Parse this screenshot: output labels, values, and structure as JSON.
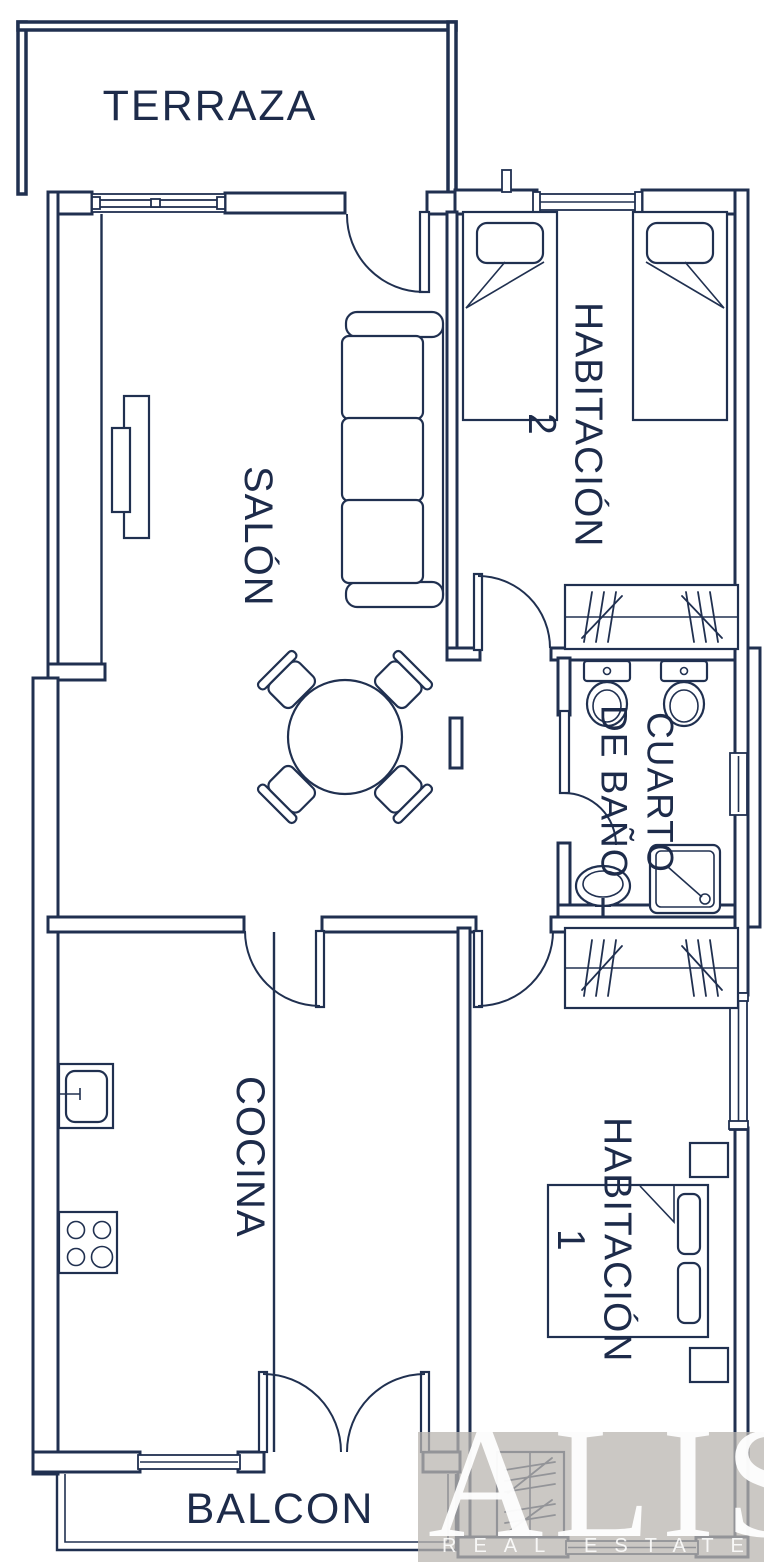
{
  "rooms": {
    "terraza": "TERRAZA",
    "salon": "SALÓN",
    "habitacion2": {
      "name": "HABITACIÓN",
      "number": "2"
    },
    "cuarto_de_bano": {
      "line1": "CUARTO",
      "line2": "DE BAÑO"
    },
    "cocina": "COCINA",
    "habitacion1": {
      "name": "HABITACIÓN",
      "number": "1"
    },
    "balcon": "BALCON"
  },
  "logo": {
    "brand": "ALISÚ",
    "tagline": "REAL ESTATE"
  },
  "symbols": [
    "single-bed",
    "double-bed",
    "wardrobe",
    "closet",
    "sofa",
    "round-dining-table",
    "chair",
    "toilet",
    "washbasin",
    "shower-tray",
    "kitchen-sink",
    "stove",
    "radiator",
    "door-swing",
    "window",
    "sliding-window"
  ],
  "colors": {
    "ink": "#203050",
    "label_text": "#1d2b4a",
    "logo_bg": "rgba(185,181,176,0.75)",
    "logo_text": "#ffffff"
  }
}
